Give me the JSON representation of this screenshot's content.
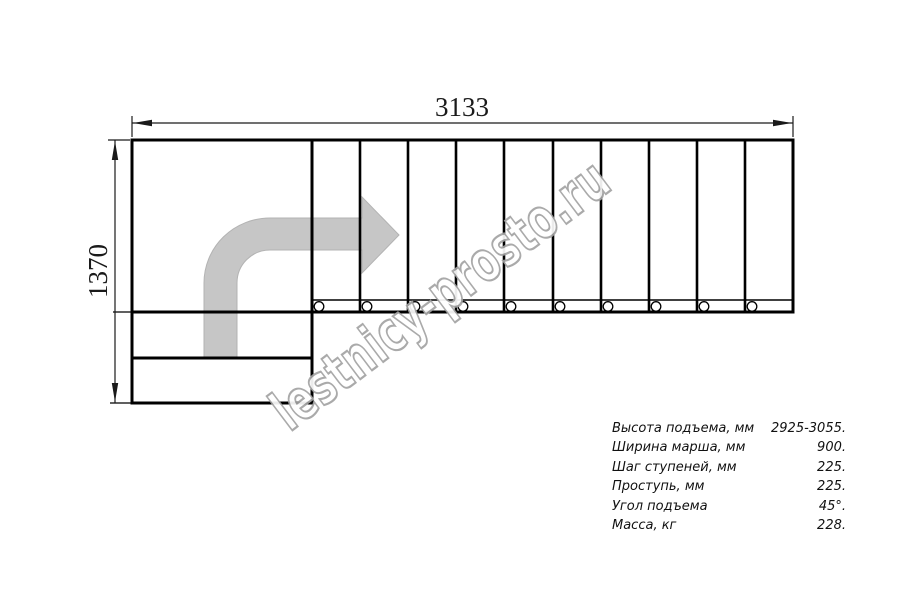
{
  "drawing": {
    "kind": "staircase-plan-top-view",
    "dimension_width_label": "3133",
    "dimension_height_label": "1370",
    "tread_count": 10,
    "baluster_circle_count": 10,
    "landing_lower_steps": 2,
    "direction_arrow": "from-bottom-landing-turn-right"
  },
  "watermark": {
    "text": "lestnicy-prosto.ru"
  },
  "specs": {
    "rows": [
      {
        "label": "Высота подъема, мм",
        "value": "2925-3055."
      },
      {
        "label": "Ширина марша, мм",
        "value": "900."
      },
      {
        "label": "Шаг ступеней, мм",
        "value": "225."
      },
      {
        "label": "Проступь, мм",
        "value": "225."
      },
      {
        "label": "Угол подъема",
        "value": "45°."
      },
      {
        "label": "Масса, кг",
        "value": "228."
      }
    ]
  },
  "colors": {
    "background": "#ffffff",
    "line": "#000000",
    "arrow_fill": "#c6c6c6",
    "arrow_outline": "#b3b3b3",
    "watermark_outline": "#a3a3a3"
  }
}
